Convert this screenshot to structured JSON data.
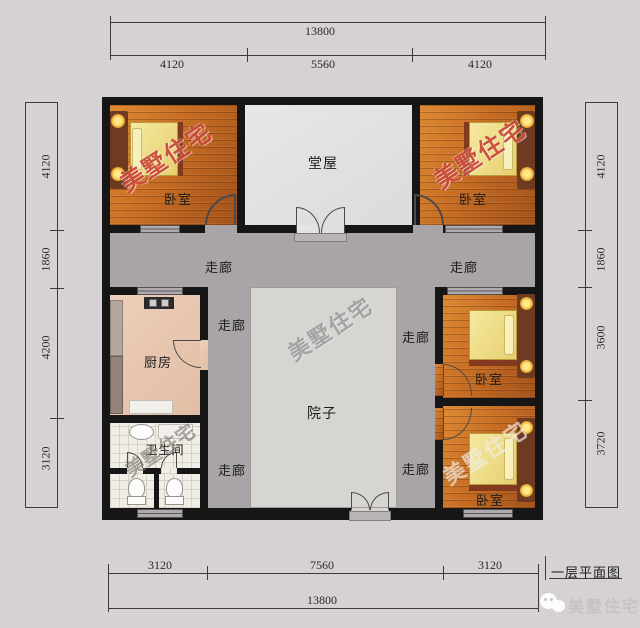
{
  "plan": {
    "caption": "一层平面图",
    "rooms": {
      "hall": "堂屋",
      "bedroom": "卧室",
      "kitchen": "厨房",
      "bathroom": "卫生间",
      "courtyard": "院子",
      "corridor": "走廊"
    },
    "dimensions": {
      "top": {
        "total": "13800",
        "segments": [
          "4120",
          "5560",
          "4120"
        ]
      },
      "bottom": {
        "total": "13800",
        "segments": [
          "3120",
          "7560",
          "3120"
        ]
      },
      "left": {
        "segments": [
          "4120",
          "1860",
          "4200",
          "3120"
        ]
      },
      "right": {
        "segments": [
          "4120",
          "1860",
          "3600",
          "3720"
        ]
      }
    },
    "watermark": {
      "text": "美墅住宅"
    },
    "footer": {
      "brand": "美墅住宅"
    },
    "colors": {
      "background": "#d6d1d4",
      "wall": "#171617",
      "corridor_gray": "#a8a4a7",
      "wood_floor": "#c76d24",
      "mattress_yellow": "#ecd97b",
      "kitchen_floor": "#e8c8b2",
      "watermark_red": "#c53724"
    }
  }
}
